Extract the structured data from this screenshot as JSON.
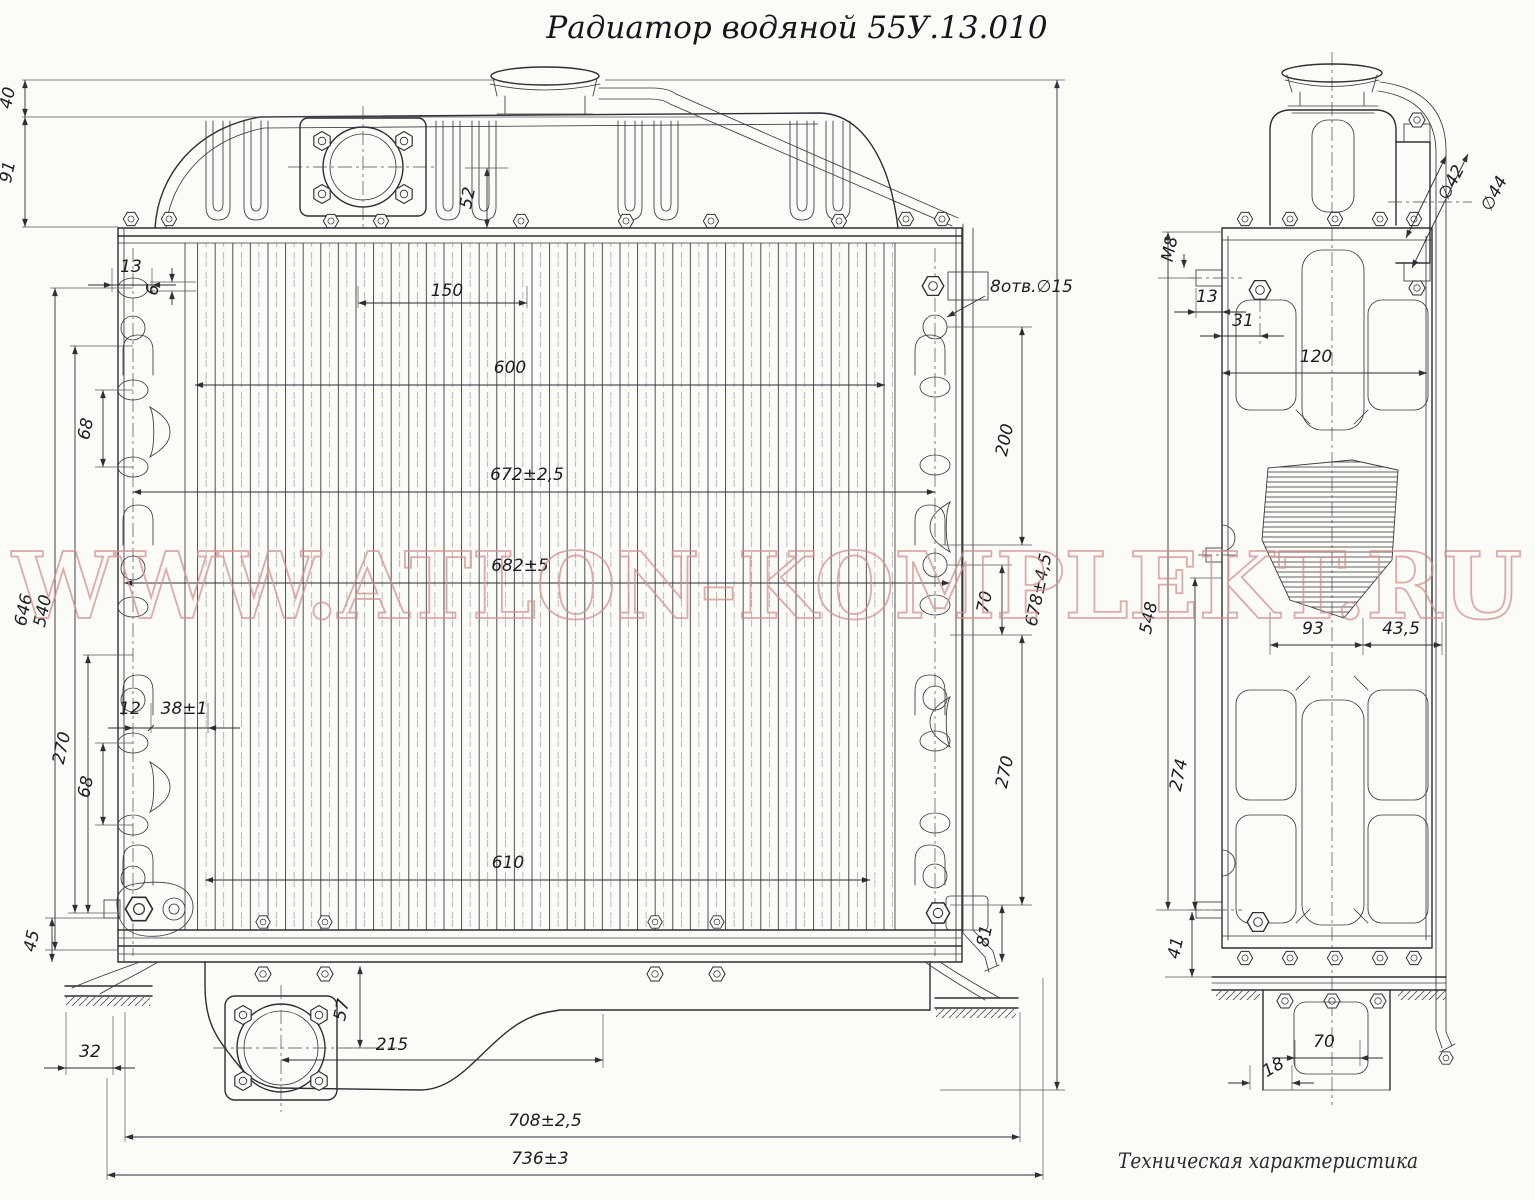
{
  "title": "Радиатор водяной 55У.13.010",
  "watermark": "WWW.ATLON-KOMPLEKT.RU",
  "note": "Техническая  характеристика",
  "front": {
    "dims": {
      "h40": "40",
      "h91": "91",
      "h52": "52",
      "w13": "13",
      "w6": "6",
      "w150": "150",
      "w600": "600",
      "w672": "672±2,5",
      "w682": "682±5",
      "w610": "610",
      "h68a": "68",
      "h646": "646",
      "h540": "540",
      "w12": "12",
      "w38": "38±1",
      "h270l": "270",
      "h68b": "68",
      "h45": "45",
      "w32": "32",
      "h57": "57",
      "w215": "215",
      "w708": "708±2,5",
      "w736": "736±3",
      "holes": "8отв.∅15",
      "h200": "200",
      "h70": "70",
      "h270r": "270",
      "h81": "81",
      "h678": "678±4,5"
    }
  },
  "side": {
    "dims": {
      "m8": "М8",
      "w13": "13",
      "w31": "31",
      "w120": "120",
      "d42": "∅42",
      "d44": "∅44",
      "h548": "548",
      "h274": "274",
      "h41": "41",
      "w93": "93",
      "w43": "43,5",
      "w70": "70",
      "w18": "18"
    }
  }
}
